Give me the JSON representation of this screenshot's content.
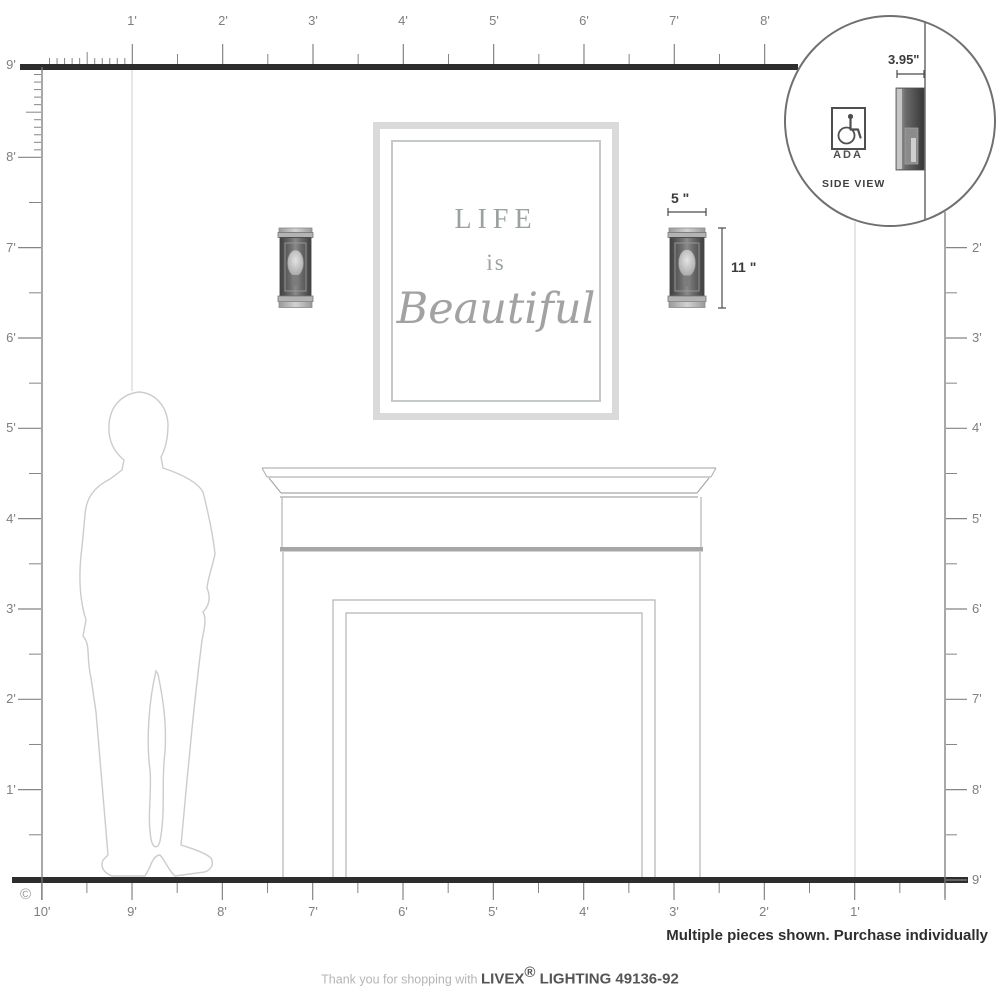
{
  "rulers": {
    "top": [
      "1'",
      "2'",
      "3'",
      "4'",
      "5'",
      "6'",
      "7'",
      "8'"
    ],
    "left": [
      "9'",
      "8'",
      "7'",
      "6'",
      "5'",
      "4'",
      "3'",
      "2'",
      "1'"
    ],
    "right": [
      "2'",
      "3'",
      "4'",
      "5'",
      "6'",
      "7'",
      "8'",
      "9'"
    ],
    "bottom": [
      "10'",
      "9'",
      "8'",
      "7'",
      "6'",
      "5'",
      "4'",
      "3'",
      "2'",
      "1'"
    ]
  },
  "art_frame": {
    "line1": "LIFE",
    "line2": "is",
    "line3": "Beautiful"
  },
  "dimensions": {
    "width_label": "5 \"",
    "height_label": "11 \"",
    "depth_label": "3.95\""
  },
  "inset": {
    "ada_label": "ADA",
    "side_view_label": "SIDE VIEW",
    "icon_name": "wheelchair-icon"
  },
  "footer": {
    "purchase_note": "Multiple pieces shown. Purchase individually",
    "thanks_prefix": "Thank you for shopping with ",
    "brand": "LIVEX",
    "registered": "®",
    "product_line": " LIGHTING 49136-92"
  },
  "copyright": "©",
  "colors": {
    "structure_line": "#2d2d2d",
    "ruler_gray": "#858585",
    "label_gray": "#7f7f7f",
    "fireplace_gray": "#b4b4b4",
    "silhouette_gray": "#cccccc",
    "sconce_dark": "#454545",
    "dimension_dark": "#3b3b3b"
  }
}
